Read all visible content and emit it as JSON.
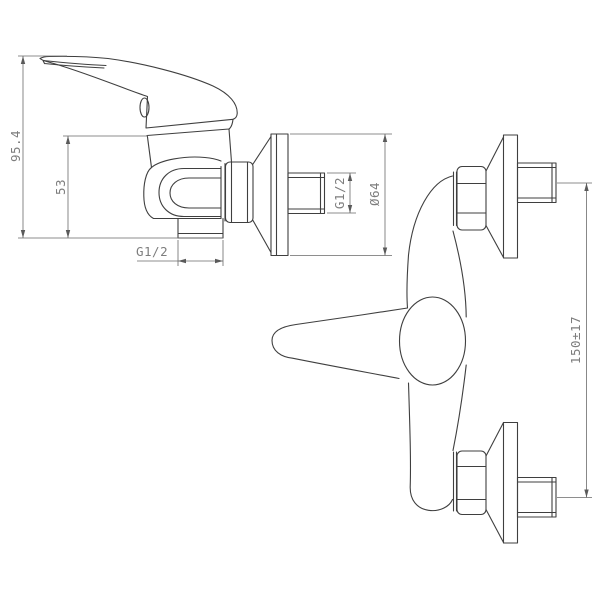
{
  "drawing": {
    "subject": "wall-mounted single-lever shower mixer",
    "side_view": {
      "dim_overall_height": "95.4",
      "dim_body_height": "53",
      "dim_outlet_thread": "G1/2",
      "dim_wall_thread": "G1/2",
      "dim_flange_diameter": "Ø64"
    },
    "front_view": {
      "dim_connection_centers": "150±17"
    },
    "colors": {
      "object_line": "#3f3f3f",
      "dimension_line": "#6a6a6a",
      "text": "#7d7d7d",
      "background": "#ffffff"
    }
  }
}
